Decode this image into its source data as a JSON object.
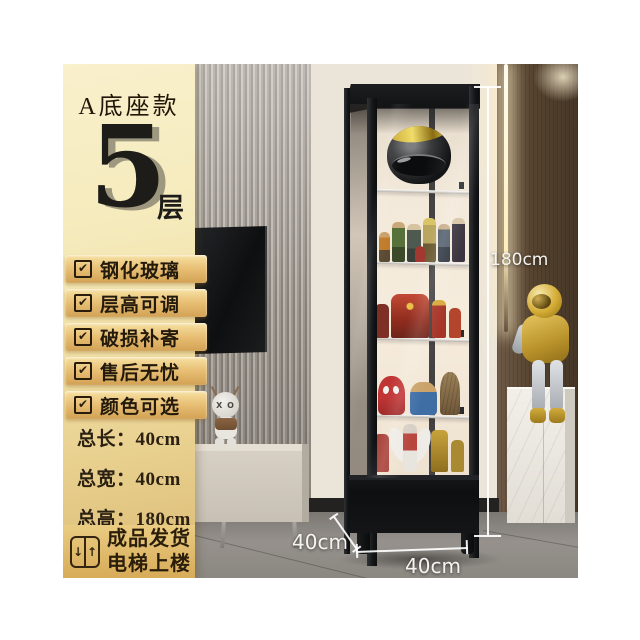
{
  "product_panel": {
    "style_label": "A底座款",
    "tier_count": "5",
    "tier_unit": "层",
    "check_glyph": "✔",
    "features": [
      "钢化玻璃",
      "层高可调",
      "破损补寄",
      "售后无忧",
      "颜色可选"
    ],
    "dimensions": [
      {
        "name": "总长：",
        "value": "40cm"
      },
      {
        "name": "总宽：",
        "value": "40cm"
      },
      {
        "name": "总高：",
        "value": "180cm"
      }
    ],
    "shipping_line1": "成品发货",
    "shipping_line2": "电梯上楼",
    "elevator_down_arrow": "↓",
    "elevator_up_arrow": "↑"
  },
  "scene_annotations": {
    "height_label": "180cm",
    "depth_label": "40cm",
    "width_label": "40cm"
  },
  "scene_text": {
    "kaws_eyes": "X O"
  },
  "colors": {
    "panel_gold_top": "#f9f0cc",
    "panel_gold_bottom": "#d9b973",
    "ribbon_gold": "#e9c177",
    "cabinet_frame": "#141517",
    "annotation_white": "#ffffff"
  }
}
